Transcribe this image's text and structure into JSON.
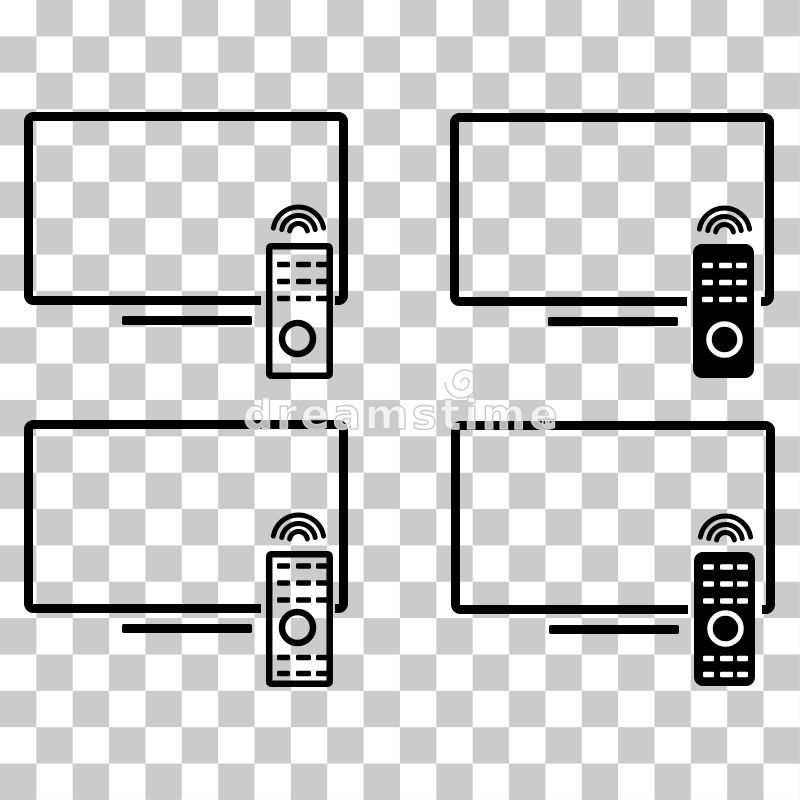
{
  "image": {
    "description": "Set of smart TV icons with wireless remote control, flat style, on transparent background",
    "background": {
      "type": "transparency-checkerboard",
      "square_px": 36,
      "colors": [
        "#ffffff",
        "#cbcbcb"
      ]
    }
  },
  "colors": {
    "icon_black": "#000000",
    "remote_detail_white": "#ffffff",
    "watermark_gray": "#cfcfcf"
  },
  "icons": [
    {
      "id": "tv-remote-icon-top-left",
      "tv_style": "outline",
      "remote_style": "outline",
      "remote_bottom_dashes": false,
      "signal_waves": 3,
      "dash_rows_top": 3
    },
    {
      "id": "tv-remote-icon-top-right",
      "tv_style": "outline",
      "remote_style": "filled",
      "remote_bottom_dashes": false,
      "signal_waves": 3,
      "dash_rows_top": 3
    },
    {
      "id": "tv-remote-icon-bottom-left",
      "tv_style": "outline",
      "remote_style": "outline",
      "remote_bottom_dashes": true,
      "signal_waves": 3,
      "dash_rows_top": 3
    },
    {
      "id": "tv-remote-icon-bottom-right",
      "tv_style": "outline",
      "remote_style": "filled",
      "remote_bottom_dashes": true,
      "signal_waves": 3,
      "dash_rows_top": 3
    }
  ],
  "watermark": {
    "brand": "dreamstime",
    "registered_mark": "®",
    "logo": "spiral"
  }
}
